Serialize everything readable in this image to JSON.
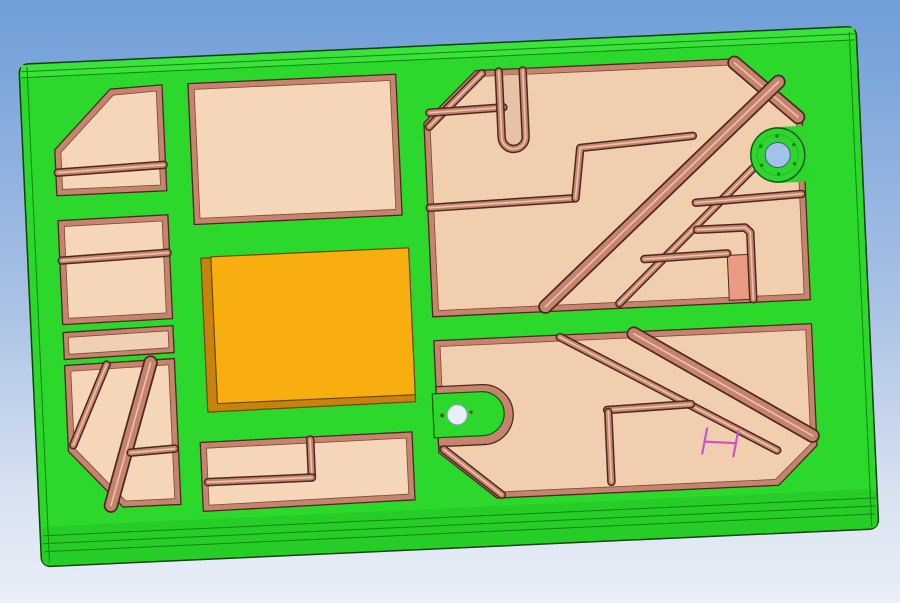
{
  "viewport": {
    "type": "3d-cad-viewport",
    "width": 900,
    "height": 603,
    "object": "green machined pocket plate, slightly rotated, viewed face-on",
    "pocket_count": 8,
    "through_hole_count": 2,
    "features": [
      "outer green frame with filleted top and bottom edge bands",
      "left column: four peach pockets, one chamfered with rib, one with diagonal ribs",
      "middle column: plain rectangular pocket, raised orange rectangular boss, bottom pocket with L-shaped rib",
      "right column: large ribbed pocket with chamfers, U-channel, diagonal rib bands, round green boss with through-hole",
      "lower right pocket with diagonal ribs and green tab with small through-hole",
      "small salmon insert tab",
      "pink measurement annotation marker"
    ]
  },
  "colors": {
    "bg_top": "#6f9ed8",
    "bg_mid": "#a9c1e5",
    "bg_low": "#d8e2f1",
    "bg_bottom": "#eaeff8",
    "face_green": "#2bd82b",
    "band_top": "#3ce23c",
    "band_bottom": "#27cd27",
    "green_line": "#0d860d",
    "part_outline": "#12400f",
    "rim": "#c6846e",
    "rim_dark": "#4a2a20",
    "rim_light": "#edc3aa",
    "floor": "#f5d6b8",
    "floor_right": "#f1ceae",
    "floor_strip": "#efd0b4",
    "channel": "#e8c2a5",
    "floor_stroke": "#7a4a38",
    "orange": "#f9ae0f",
    "orange_side": "#c8830e",
    "orange_outline": "#6b4a08",
    "boss_green": "#2fd42f",
    "boss_ring": "#23bb23",
    "boss_outline": "#0a5c0a",
    "hole_sky": "#a3c2e9",
    "hole_sky_stroke": "#3c5f85",
    "hole_light": "#e9effa",
    "hole_light_stroke": "#93a3b8",
    "screw": "#1f7a1f",
    "screw_dark": "#6b4437",
    "salmon": "#eb9b84",
    "marker": "#c757c7"
  }
}
